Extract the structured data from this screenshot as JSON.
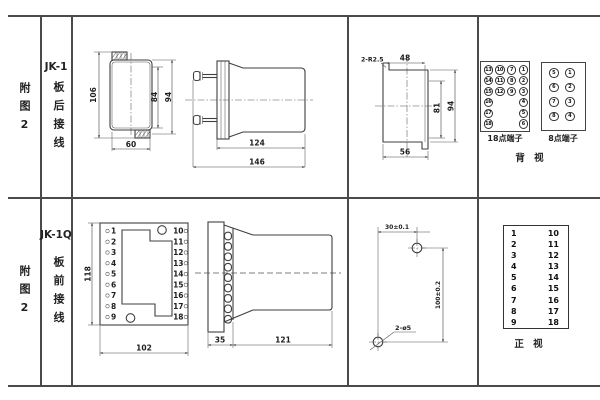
{
  "sheet": {
    "bg": "#ffffff",
    "line_color": "#4a4a4a"
  },
  "rows": [
    {
      "fig_label": "附图2",
      "model": "JK-1",
      "wiring": "板后接线",
      "front_view": {
        "dim_left": "106",
        "dim_right_inner": "84",
        "dim_right_outer": "94",
        "dim_bottom": "60"
      },
      "side_view": {
        "dim_upper": "124",
        "dim_lower": "146"
      },
      "cutout_view": {
        "note": "2-R2.5",
        "dim_top": "48",
        "dim_right_inner": "81",
        "dim_right_outer": "94",
        "dim_bottom": "56"
      },
      "terminal18": {
        "label": "18点端子",
        "rows": [
          [
            13,
            10,
            7,
            1
          ],
          [
            14,
            11,
            8,
            2
          ],
          [
            15,
            12,
            9,
            3
          ],
          [
            16,
            null,
            null,
            4
          ],
          [
            17,
            null,
            null,
            5
          ],
          [
            18,
            null,
            null,
            6
          ]
        ]
      },
      "terminal8": {
        "label": "8点端子",
        "rows": [
          [
            5,
            1
          ],
          [
            6,
            2
          ],
          [
            7,
            3
          ],
          [
            8,
            4
          ]
        ]
      },
      "view_label": "背 视"
    },
    {
      "fig_label": "附图2",
      "model": "JK-1Q",
      "wiring": "板前接线",
      "panel_view": {
        "dim_left": "118",
        "dim_bottom": "102",
        "left_terminals": [
          "1",
          "2",
          "3",
          "4",
          "5",
          "6",
          "7",
          "8",
          "9"
        ],
        "right_terminals": [
          "10",
          "11",
          "12",
          "13",
          "14",
          "15",
          "16",
          "17",
          "18"
        ]
      },
      "side_view": {
        "dim_left": "35",
        "dim_right": "121"
      },
      "drill_view": {
        "dim_top": "30±0.1",
        "dim_right": "100±0.2",
        "note": "2-ø5"
      },
      "front_table": {
        "left": [
          "1",
          "2",
          "3",
          "4",
          "5",
          "6",
          "7",
          "8",
          "9"
        ],
        "right": [
          "10",
          "11",
          "12",
          "13",
          "14",
          "15",
          "16",
          "17",
          "18"
        ]
      },
      "view_label": "正 视"
    }
  ]
}
